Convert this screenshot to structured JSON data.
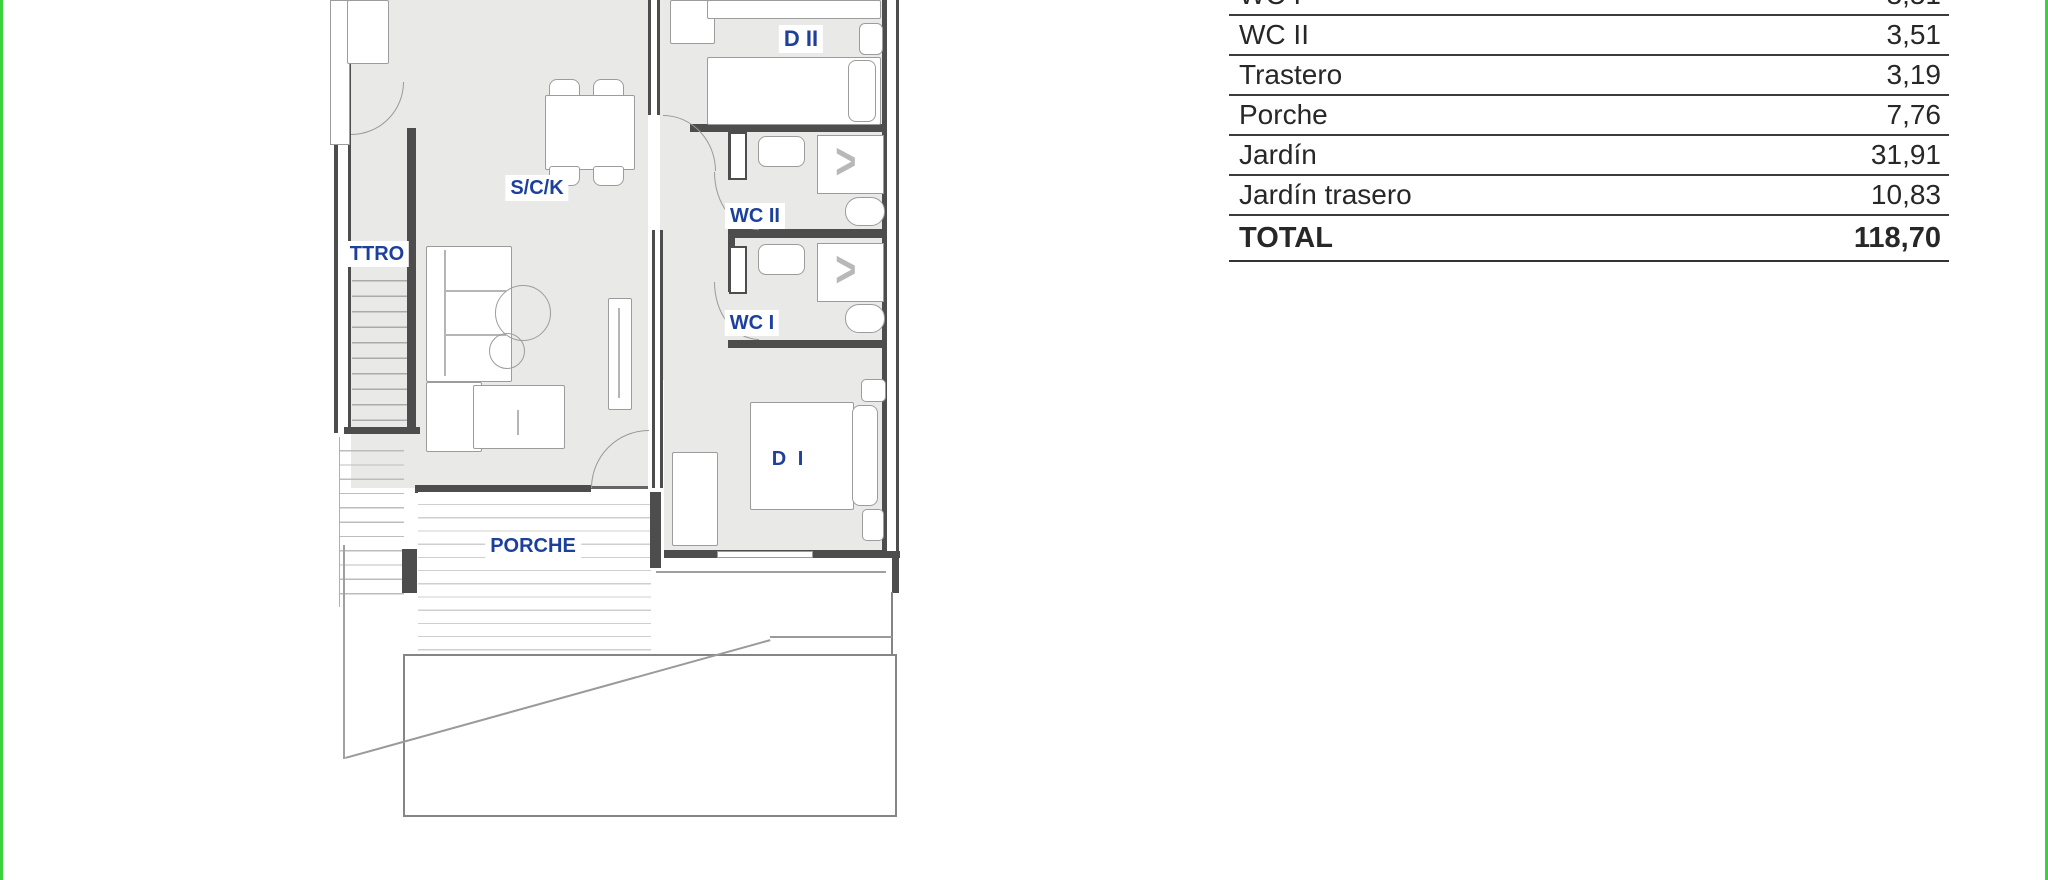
{
  "plan": {
    "rooms": {
      "d2": "D II",
      "sck": "S/C/K",
      "ttro": "TTRO",
      "wc2": "WC II",
      "wc1": "WC I",
      "d1": "D I",
      "porche": "PORCHE"
    },
    "shower_symbol": ">"
  },
  "areas_table": {
    "rows": [
      {
        "label": "WC I",
        "value": "3,51"
      },
      {
        "label": "WC II",
        "value": "3,51"
      },
      {
        "label": "Trastero",
        "value": "3,19"
      },
      {
        "label": "Porche",
        "value": "7,76"
      },
      {
        "label": "Jardín",
        "value": "31,91"
      },
      {
        "label": "Jardín trasero",
        "value": "10,83"
      }
    ],
    "total": {
      "label": "TOTAL",
      "value": "118,70"
    }
  },
  "colors": {
    "accent_green": "#3bd23b",
    "label_blue": "#1d409c",
    "wall_dark": "#4d4d4d",
    "floor_gray": "#e9e9e8"
  }
}
